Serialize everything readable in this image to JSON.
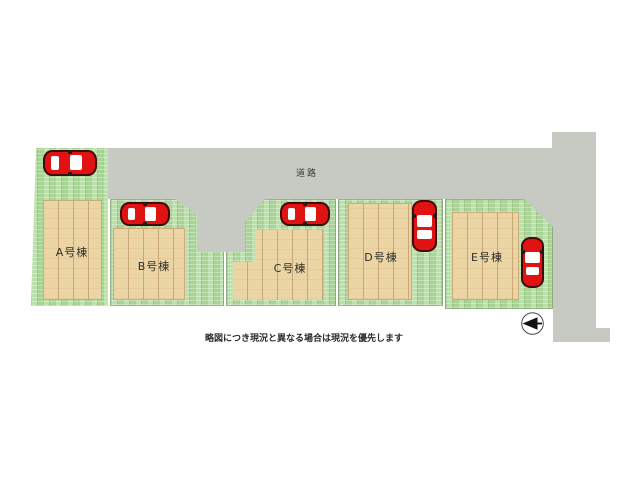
{
  "plan": {
    "road": {
      "label": "道路"
    },
    "caption": "略図につき現況と異なる場合は現況を優先します",
    "lots": [
      {
        "id": "A",
        "label": "A号棟",
        "car": "red-car"
      },
      {
        "id": "B",
        "label": "B号棟",
        "car": "red-car"
      },
      {
        "id": "C",
        "label": "C号棟",
        "car": "red-car"
      },
      {
        "id": "D",
        "label": "D号棟",
        "car": "red-car"
      },
      {
        "id": "E",
        "label": "E号棟",
        "car": "red-car"
      }
    ],
    "compass": {
      "type": "north-arrow",
      "direction": "left"
    },
    "colors": {
      "road": "#c6cac2",
      "grass": "#b4dda2",
      "building": "#ecd5a5",
      "car": "#e01212"
    }
  }
}
